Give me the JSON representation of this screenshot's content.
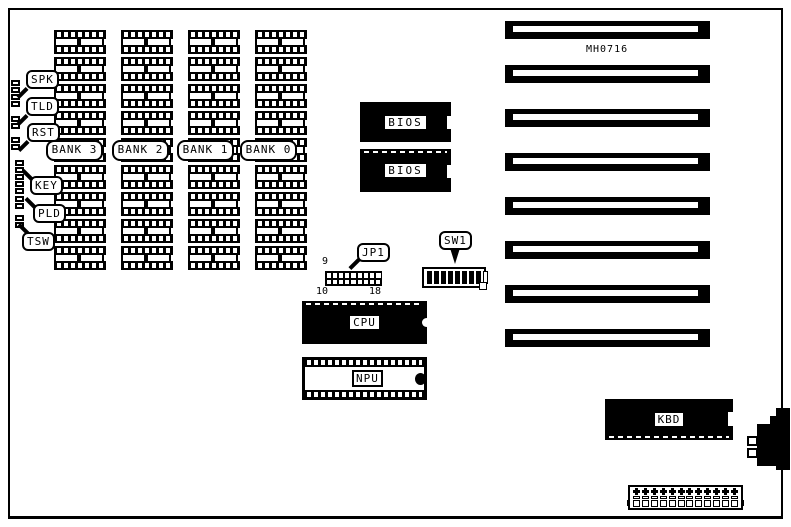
{
  "board": {
    "model": "MH0716"
  },
  "left_headers": [
    {
      "label": "SPK",
      "cells": 4
    },
    {
      "label": "TLD",
      "cells": 2
    },
    {
      "label": "RST",
      "cells": 2
    },
    {
      "label": "KEY",
      "cells": 5
    },
    {
      "label": "PLD",
      "cells": 2
    },
    {
      "label": "TSW",
      "cells": 2
    }
  ],
  "banks": [
    {
      "label": "BANK 3"
    },
    {
      "label": "BANK 2"
    },
    {
      "label": "BANK 1"
    },
    {
      "label": "BANK 0"
    }
  ],
  "memory": {
    "columns": 4,
    "chips_per_column": 9
  },
  "bios": {
    "top": "BIOS",
    "bottom": "BIOS"
  },
  "cpu": {
    "label": "CPU"
  },
  "npu": {
    "label": "NPU"
  },
  "kbd": {
    "label": "KBD"
  },
  "jumper": {
    "label": "JP1",
    "pin_top_left": "9",
    "pin_bottom_left": "10",
    "pin_bottom_right": "18",
    "rows": 2,
    "cols": 9
  },
  "dip_switch": {
    "label": "SW1",
    "positions": 8
  },
  "expansion": {
    "slot_count": 8
  },
  "power": {
    "pin_count": 12
  },
  "colors": {
    "ink": "#000000",
    "paper": "#ffffff"
  }
}
